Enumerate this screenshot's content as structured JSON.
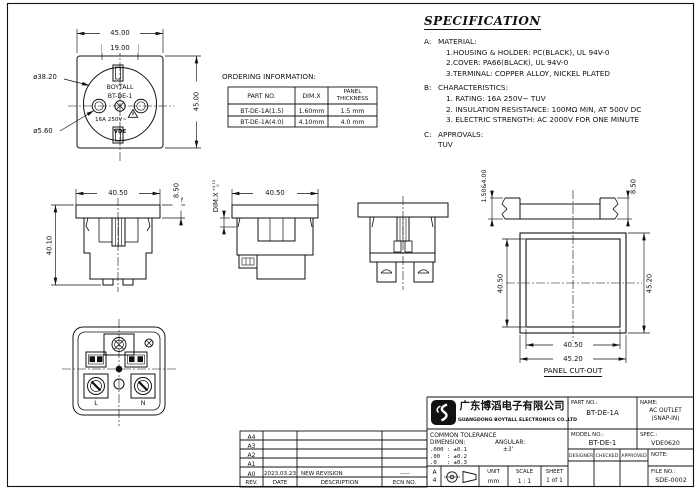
{
  "front_view": {
    "dim_width": "45.00",
    "dim_inner": "19.00",
    "dim_height": "45.00",
    "dia_body": "ø38.20",
    "dia_hole": "ø5.60",
    "brand": "BOYTALL",
    "model": "BT-DE-1",
    "rating": "16A 250V~",
    "cert_mark": "VDE"
  },
  "ordering": {
    "heading": "ORDERING INFORMATION:",
    "col_part": "PART NO.",
    "col_dimx": "DIM.X",
    "col_panel": "PANEL THICKNESS",
    "rows": [
      {
        "part": "BT-DE-1A(1.5)",
        "dimx": "1.60mm",
        "panel": "1.5 mm"
      },
      {
        "part": "BT-DE-1A(4.0)",
        "dimx": "4.10mm",
        "panel": "4.0 mm"
      }
    ]
  },
  "specification": {
    "title": "SPECIFICATION",
    "sections": [
      {
        "label": "A:",
        "heading": "MATERIAL:",
        "items": [
          "1.HOUSING & HOLDER: PC(BLACK), UL 94V-0",
          "2.COVER: PA66(BLACK), UL 94V-0",
          "3.TERMINAL: COPPER ALLOY, NICKEL PLATED"
        ]
      },
      {
        "label": "B:",
        "heading": "CHARACTERISTICS:",
        "items": [
          "1. RATING: 16A 250V~ TUV",
          "2. INSULATION RESISTANCE: 100MΩ MIN, AT 500V DC",
          "3. ELECTRIC STRENGTH: AC 2000V FOR ONE MINUTE"
        ]
      },
      {
        "label": "C:",
        "heading": "APPROVALS:",
        "items": [
          "TUV"
        ]
      }
    ]
  },
  "views": {
    "side1": {
      "dim_top": "40.50",
      "dim_flange": "8.50",
      "dim_height": "40.10"
    },
    "side2": {
      "dim_top": "40.50",
      "dimx_label": "DIM.X",
      "tol_plus": "+0.15",
      "tol_minus": "0"
    },
    "section": {
      "dim_thickness": "1.50&4.00",
      "dim_flange": "8.50"
    },
    "cutout": {
      "dim_left": "40.50",
      "dim_right": "45.20",
      "dim_bottom_inner": "40.50",
      "dim_bottom_outer": "45.20",
      "caption": "PANEL CUT-OUT"
    },
    "back": {
      "label_live": "L",
      "label_neutral": "N"
    }
  },
  "revision_table": {
    "revs": [
      "A4",
      "A3",
      "A2",
      "A1",
      "A0"
    ],
    "a0": {
      "date": "2023.03.23",
      "description": "NEW REVISION",
      "ecn": "-----"
    },
    "footer": {
      "rev": "REV.",
      "date": "DATE",
      "description": "DESCRIPTION",
      "ecn": "ECN NO."
    }
  },
  "title_block": {
    "company_cn": "广东博滔电子有限公司",
    "company_en": "GUANGDONG BOYTALL ELECTRONICS CO.,LTD",
    "part_no_label": "PART NO.:",
    "part_no": "BT-DE-1A",
    "name_label": "NAME:",
    "name_line1": "AC OUTLET",
    "name_line2": "(SNAP-IN)",
    "model_no_label": "MODEL NO.:",
    "model_no": "BT-DE-1",
    "spec_label": "SPEC.:",
    "spec_value": "VDE0620",
    "designer_label": "DESIGNER",
    "checked_label": "CHECKED",
    "approved_label": "APPROVED",
    "note_label": "NOTE:",
    "file_no_label": "FILE NO.:",
    "file_no": "SDE-0002",
    "tolerance": {
      "title": "COMMON TOLERANCE",
      "dimension_label": "DIMENSION:",
      "angular_label": "ANGULAR:",
      "angular_value": "±3'",
      "rows": [
        ".000 : ±0.1",
        ".00  : ±0.2",
        ".0   : ±0.3"
      ]
    },
    "sheet": {
      "size_row1": "A",
      "size_row2": "4",
      "unit_label": "UNIT",
      "unit_value": "mm",
      "scale_label": "SCALE",
      "scale_value": "1 : 1",
      "sheet_label": "SHEET",
      "sheet_value": "1 of 1"
    }
  }
}
